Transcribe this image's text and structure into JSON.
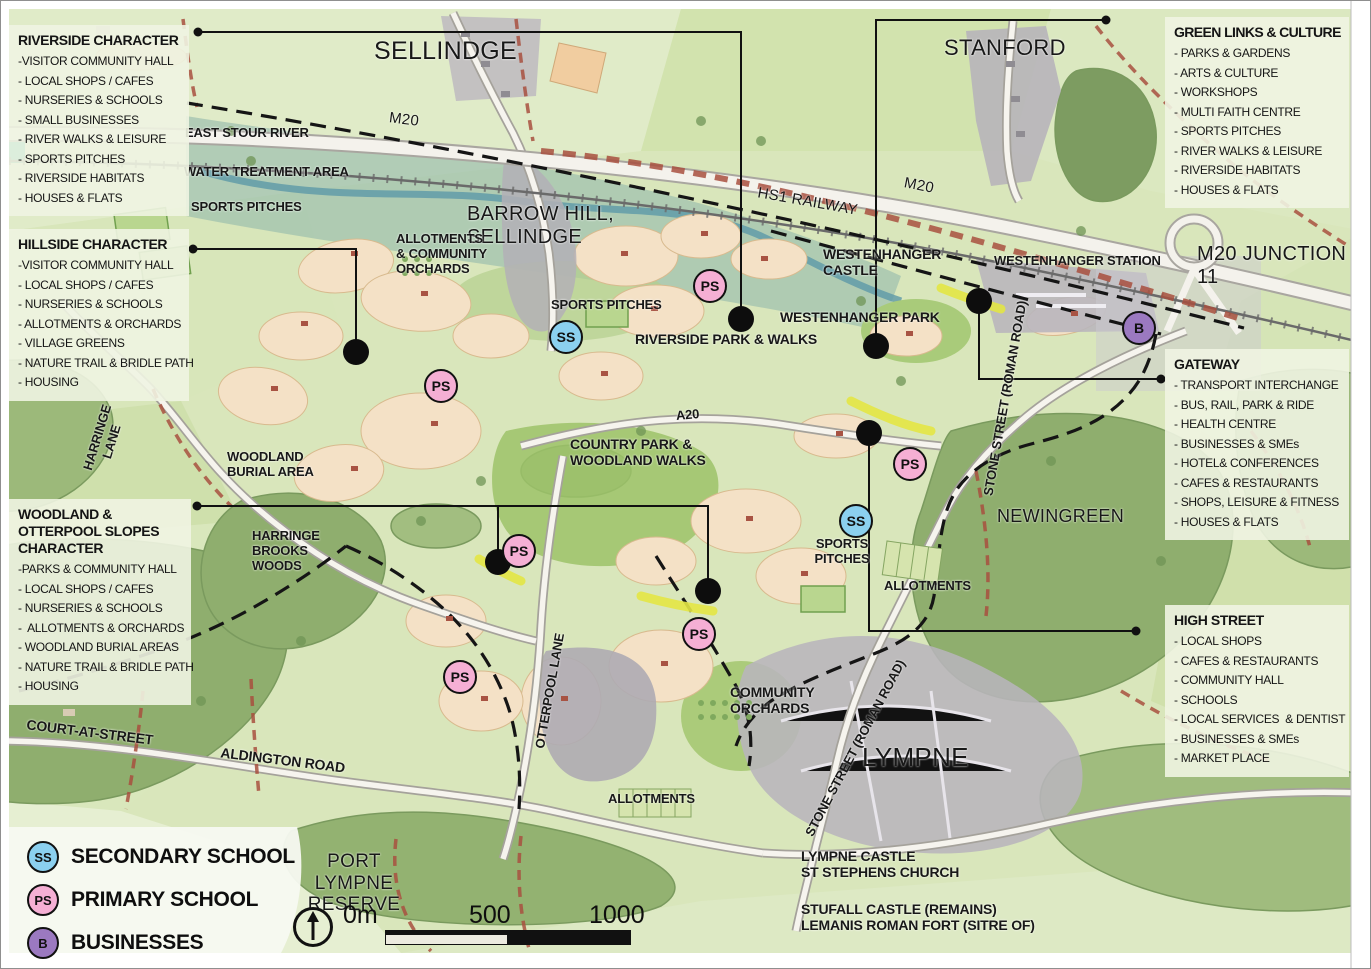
{
  "map_labels": {
    "sellindge": "SELLINDGE",
    "stanford": "STANFORD",
    "m20_west": "M20",
    "m20_east": "M20",
    "hs1": "HS1  RAILWAY",
    "m20_junction": "M20 JUNCTION 11",
    "east_stour": "EAST STOUR RIVER",
    "water_treatment": "WATER TREATMENT AREA",
    "sports_pitches_nw": "SPORTS PITCHES",
    "barrow_hill": "BARROW HILL,\nSELLINDGE",
    "allotments_orchards": "ALLOTMENTS\n& COMMUNITY\nORCHARDS",
    "sports_pitches_center": "SPORTS PITCHES",
    "riverside_park": "RIVERSIDE PARK & WALKS",
    "westenhanger_castle": "WESTENHANGER\nCASTLE",
    "westenhanger_park": "WESTENHANGER PARK",
    "westenhanger_station": "WESTENHANGER STATION",
    "stone_street_north": "STONE STREET (ROMAN ROAD)",
    "stone_street_south": "STONE STREET (ROMAN ROAD)",
    "newingreen": "NEWINGREEN",
    "a20": "A20",
    "country_park": "COUNTRY PARK &\nWOODLAND WALKS",
    "harringe_lane": "HARRINGE\nLANE",
    "woodland_burial": "WOODLAND\nBURIAL AREA",
    "harringe_brooks": "HARRINGE\nBROOKS\nWOODS",
    "sports_pitches_east": "SPORTS\nPITCHES",
    "allotments_east": "ALLOTMENTS",
    "otterpool_lane": "OTTERPOOL LANE",
    "community_orchards": "COMMUNITY\nORCHARDS",
    "lympne": "LYMPNE",
    "court_at_street": "COURT-AT-STREET",
    "aldington_road": "ALDINGTON ROAD",
    "allotments_south": "ALLOTMENTS",
    "port_lympne": "PORT LYMPNE\nRESERVE",
    "lympne_castle": "LYMPNE CASTLE\nST STEPHENS CHURCH",
    "stufall_castle": "STUFALL CASTLE (REMAINS)\nLEMANIS ROMAN FORT (SITRE OF)"
  },
  "callouts": {
    "riverside": {
      "title": "RIVERSIDE CHARACTER",
      "items": [
        "-VISITOR COMMUNITY HALL",
        "- LOCAL SHOPS / CAFES",
        "- NURSERIES & SCHOOLS",
        "- SMALL BUSINESSES",
        "- RIVER WALKS & LEISURE",
        "- SPORTS PITCHES",
        "- RIVERSIDE HABITATS",
        "- HOUSES & FLATS"
      ]
    },
    "hillside": {
      "title": "HILLSIDE CHARACTER",
      "items": [
        "-VISITOR COMMUNITY HALL",
        "- LOCAL SHOPS / CAFES",
        "- NURSERIES & SCHOOLS",
        "- ALLOTMENTS & ORCHARDS",
        "- VILLAGE GREENS",
        "- NATURE TRAIL & BRIDLE PATH",
        "- HOUSING"
      ]
    },
    "woodland": {
      "title": "WOODLAND &\nOTTERPOOL SLOPES\nCHARACTER",
      "items": [
        "-PARKS & COMMUNITY HALL",
        "- LOCAL SHOPS / CAFES",
        "- NURSERIES & SCHOOLS",
        "-  ALLOTMENTS & ORCHARDS",
        "- WOODLAND BURIAL AREAS",
        "- NATURE TRAIL & BRIDLE PATH",
        "- HOUSING"
      ]
    },
    "green_links": {
      "title": "GREEN LINKS & CULTURE",
      "items": [
        "- PARKS & GARDENS",
        "- ARTS & CULTURE",
        "- WORKSHOPS",
        "- MULTI FAITH CENTRE",
        "- SPORTS PITCHES",
        "- RIVER WALKS & LEISURE",
        "- RIVERSIDE HABITATS",
        "- HOUSES & FLATS"
      ]
    },
    "gateway": {
      "title": "GATEWAY",
      "items": [
        "- TRANSPORT INTERCHANGE",
        "- BUS, RAIL, PARK & RIDE",
        "- HEALTH CENTRE",
        "- BUSINESSES & SMEs",
        "- HOTEL& CONFERENCES",
        "- CAFES & RESTAURANTS",
        "- SHOPS, LEISURE & FITNESS",
        "- HOUSES & FLATS"
      ]
    },
    "high_street": {
      "title": "HIGH STREET",
      "items": [
        "- LOCAL SHOPS",
        "- CAFES & RESTAURANTS",
        "- COMMUNITY HALL",
        "- SCHOOLS",
        "- LOCAL SERVICES  & DENTIST",
        "- BUSINESSES & SMEs",
        "- MARKET PLACE"
      ]
    }
  },
  "legend": {
    "items": [
      {
        "symbol": "SS",
        "label": "SECONDARY SCHOOL",
        "color": "#8bd0ef"
      },
      {
        "symbol": "PS",
        "label": "PRIMARY SCHOOL",
        "color": "#f5afd4"
      },
      {
        "symbol": "B",
        "label": "BUSINESSES",
        "color": "#9b79c0"
      }
    ]
  },
  "marker_symbols": {
    "ss": "SS",
    "ps": "PS",
    "b": "B"
  },
  "scalebar": {
    "zero": "0m",
    "mid": "500",
    "end": "1000"
  },
  "colors": {
    "map_background": "#d9e6bb",
    "woodland": "#92b173",
    "development_parcel": "#f4e1c6",
    "urban": "#b8b5bc",
    "boundary": "#151515",
    "bridleway_red": "#a8503f",
    "highlight_yellow": "#e3e645",
    "secondary_school": "#8bd0ef",
    "primary_school": "#f5afd4",
    "businesses": "#9b79c0"
  }
}
